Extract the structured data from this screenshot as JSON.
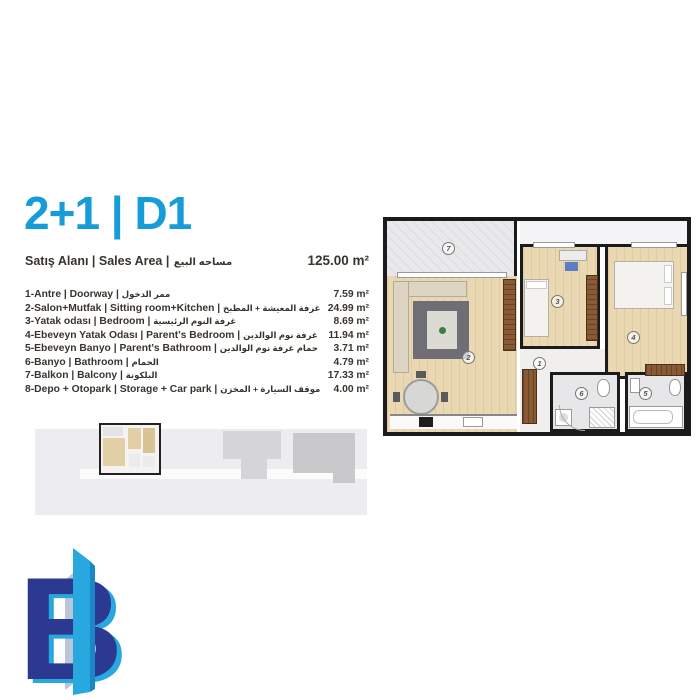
{
  "unit": {
    "title": "2+1 | D1"
  },
  "sales_area": {
    "label": "Satış Alanı | Sales Area  |",
    "label_ar": "مساحه البيع",
    "value": "125.00 m²"
  },
  "rooms": [
    {
      "text": "1-Antre | Doorway |",
      "ar": "ممر الدخول",
      "area": "7.59 m²"
    },
    {
      "text": "2-Salon+Mutfak | Sitting room+Kitchen |",
      "ar": "غرفة المعيشة + المطبخ",
      "area": "24.99 m²"
    },
    {
      "text": "3-Yatak odası | Bedroom |",
      "ar": "غرفة النوم الرئيسية",
      "area": "8.69 m²"
    },
    {
      "text": "4-Ebeveyn Yatak Odası | Parent's Bedroom |",
      "ar": "غرفة نوم الوالدين",
      "area": "11.94 m²"
    },
    {
      "text": "5-Ebeveyn Banyo | Parent's Bathroom |",
      "ar": "حمام غرفة نوم الوالدين",
      "area": "3.71 m²"
    },
    {
      "text": "6-Banyo | Bathroom |",
      "ar": "الحمام",
      "area": "4.79 m²"
    },
    {
      "text": "7-Balkon | Balcony |",
      "ar": "البلكونة",
      "area": "17.33 m²"
    },
    {
      "text": "8-Depo + Otopark | Storage + Car park |",
      "ar": "موقف السيارة + المخزن",
      "area": "4.00 m²"
    }
  ],
  "floor_plan": {
    "labels": {
      "hall": "1",
      "living": "2",
      "bedroom": "3",
      "parent_bedroom": "4",
      "parent_bathroom": "5",
      "bathroom": "6",
      "balcony": "7"
    }
  },
  "logo": {
    "letter": "B"
  },
  "colors": {
    "accent_blue": "#189cd8",
    "text": "#3a342e",
    "logo_navy": "#2b3990",
    "logo_cyan": "#29a8e0"
  }
}
